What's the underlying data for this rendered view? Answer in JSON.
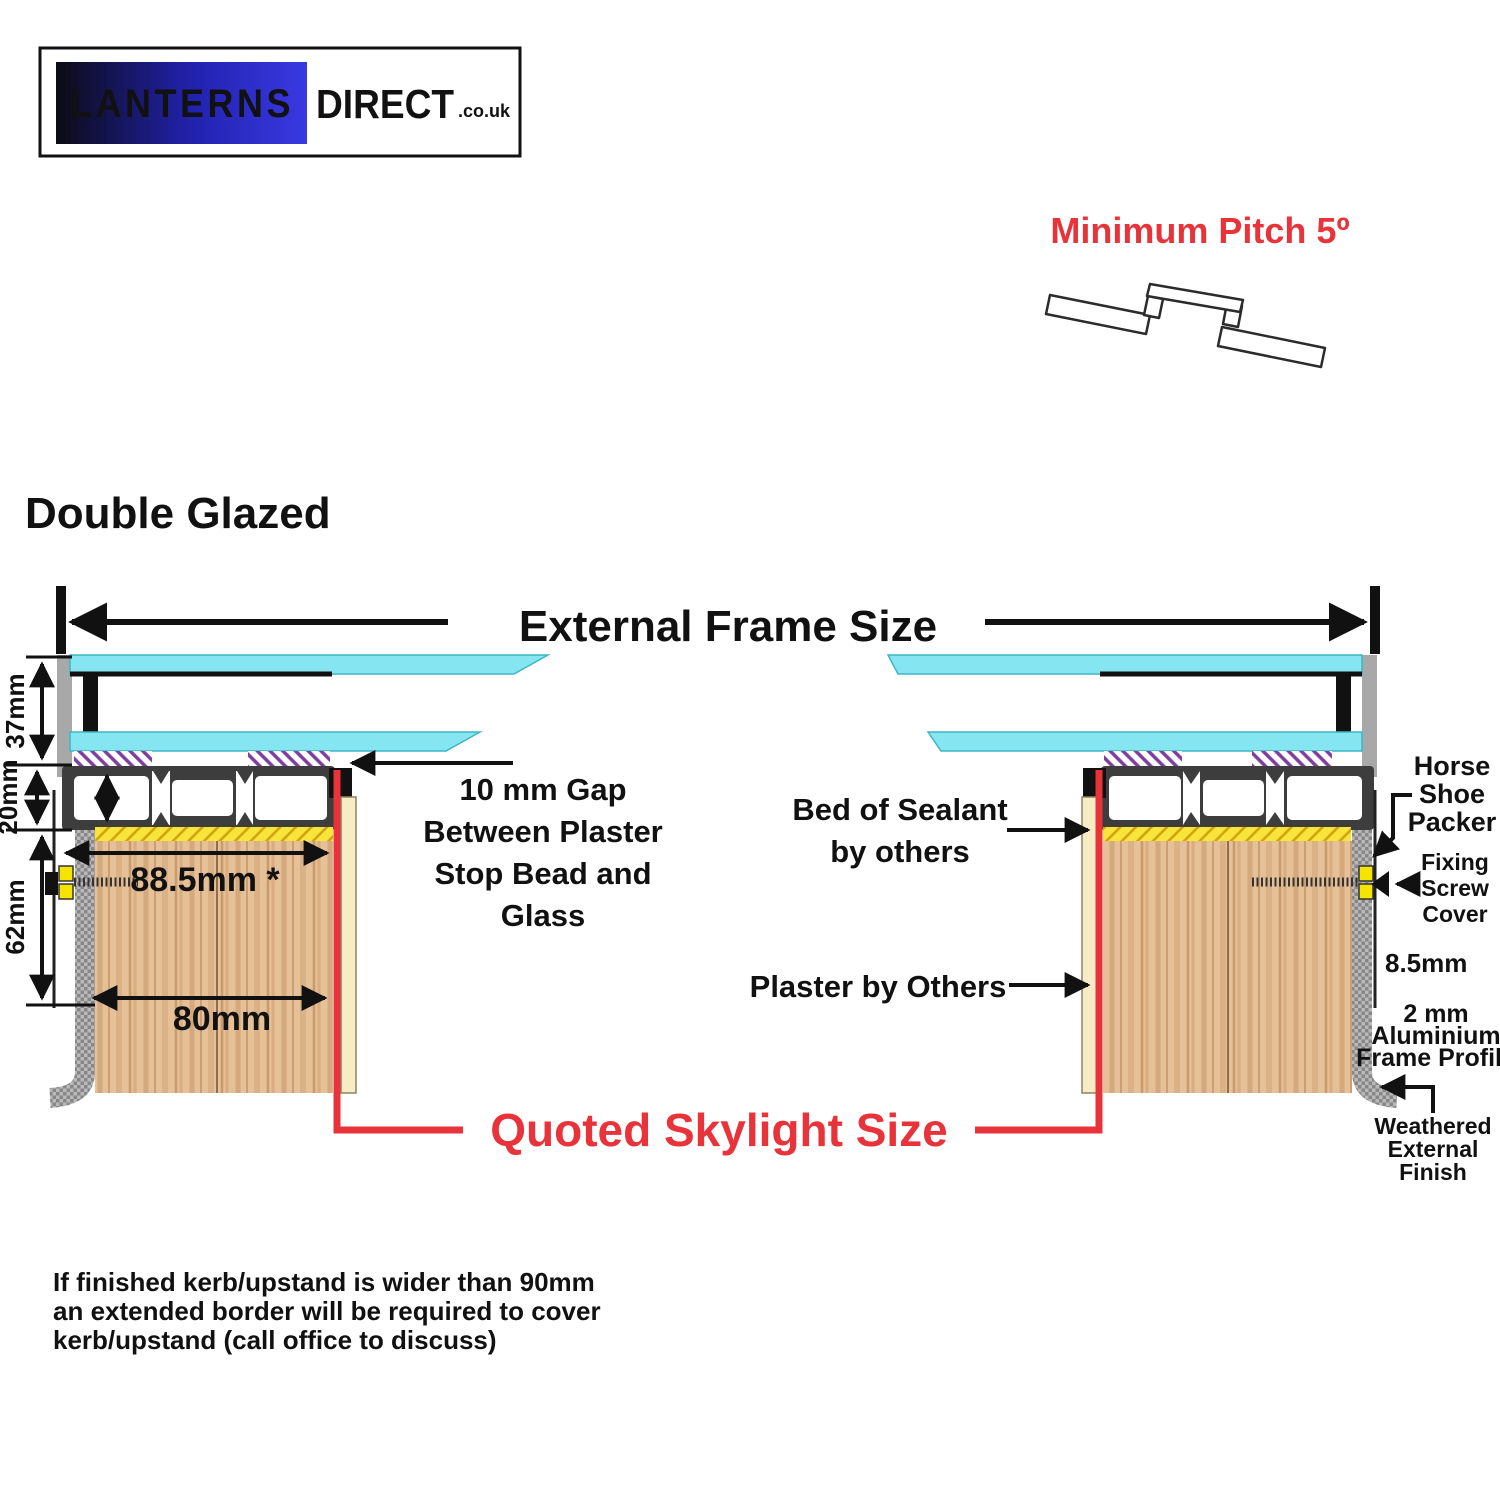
{
  "logo": {
    "name": "LANTERNS",
    "suffix": "DIRECT",
    "domain": ".co.uk"
  },
  "pitch": {
    "label": "Minimum Pitch 5º"
  },
  "diagram": {
    "title": "Double Glazed",
    "external_frame_label": "External Frame Size",
    "quoted_size_label": "Quoted Skylight Size",
    "dimensions": {
      "glazing_height": "37mm",
      "frame_height": "20mm",
      "kerb_depth": "62mm",
      "border_overhang": "88.5mm *",
      "kerb_width": "80mm",
      "profile_offset": "8.5mm"
    },
    "annotations": {
      "gap_lines": [
        "10 mm Gap",
        "Between Plaster",
        "Stop Bead and",
        "Glass"
      ],
      "sealant_lines": [
        "Bed of Sealant",
        "by others"
      ],
      "plaster": "Plaster by Others",
      "horseshoe_lines": [
        "Horse",
        "Shoe",
        "Packer"
      ],
      "screw_cover_lines": [
        "Fixing",
        "Screw",
        "Cover"
      ],
      "frame_profile_lines": [
        "2 mm",
        "Aluminium",
        "Frame Profile"
      ],
      "weathered_lines": [
        "Weathered",
        "External",
        "Finish"
      ]
    }
  },
  "footer": {
    "lines": [
      "If finished kerb/upstand is wider than 90mm",
      "an extended border will be required to cover",
      "kerb/upstand (call office to discuss)"
    ]
  },
  "colors": {
    "accent_red": "#e8333a",
    "glass_cyan": "#85e6f1",
    "wood_tan": "#e6c096",
    "sealant_yellow": "#f8e43a",
    "packer_yellow": "#f5e400",
    "gasket_purple": "#7d3f9d",
    "frame_dark": "#3d3d3d",
    "frame_light_gray": "#a8a8a8",
    "logo_blue": "#3939e2"
  }
}
